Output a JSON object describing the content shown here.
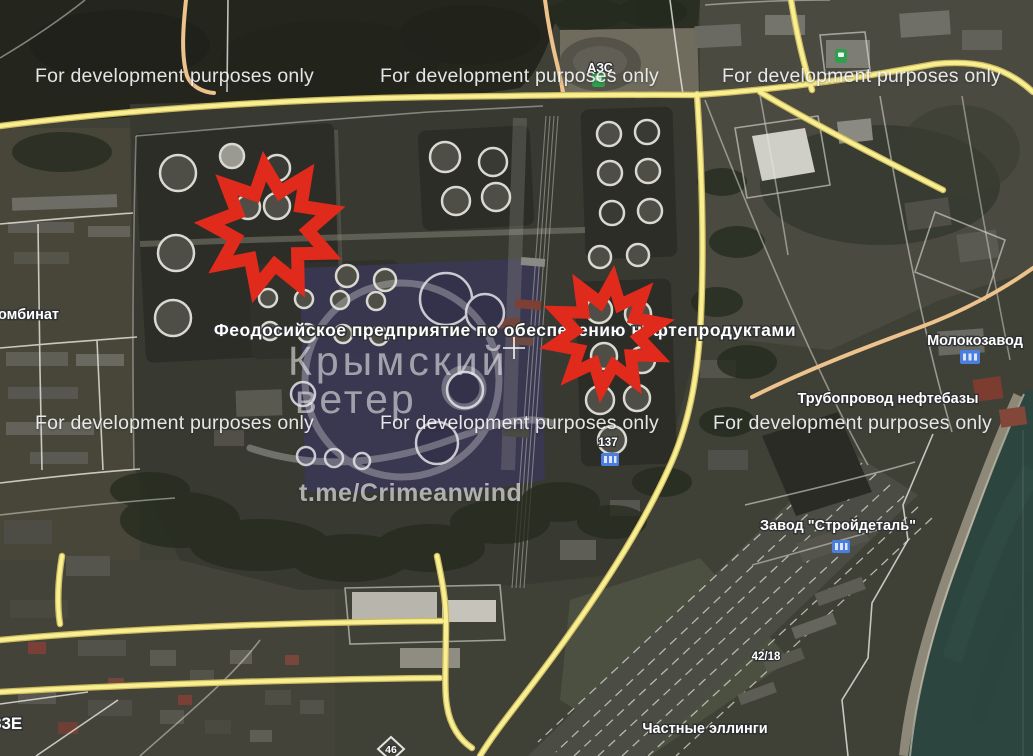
{
  "watermarks": {
    "dev_text": "For development purposes only",
    "brand_line1": "Крымский",
    "brand_line2": "ветер",
    "telegram": "t.me/Crimeanwind"
  },
  "labels": {
    "gas_station": "АЗС",
    "facility": "Феодосийское предприятие по обеспечению нефтепродуктами",
    "kombinat_partial": "омбинат",
    "milk_plant": "Молокозавод",
    "pipeline": "Трубопровод нефтебазы",
    "stroydetal_plant": "Завод \"Стройдеталь\"",
    "private_boathouses": "Частные эллинги",
    "building_137": "137",
    "building_42_18": "42/18",
    "road_83e": "83Е",
    "building_46": "46"
  },
  "markers": [
    {
      "name": "strike-marker-west",
      "cx": 271,
      "cy": 228,
      "outer": 62,
      "inner": 37,
      "points": 9,
      "rotation": -6,
      "stroke_width": 13,
      "color": "#e02a1c"
    },
    {
      "name": "strike-marker-east",
      "cx": 607,
      "cy": 334,
      "outer": 54,
      "inner": 32,
      "points": 10,
      "rotation": 6,
      "stroke_width": 12,
      "color": "#e02a1c"
    }
  ],
  "colors": {
    "road_primary_yellow": "#f8ef92",
    "road_secondary_tan": "#eec28d",
    "marker_red": "#e02a1c",
    "sea_teal": "#2c453f",
    "poi_green": "#2e9e4f",
    "poi_blue": "#4a7fe0",
    "label_halo": "#2e3032"
  }
}
